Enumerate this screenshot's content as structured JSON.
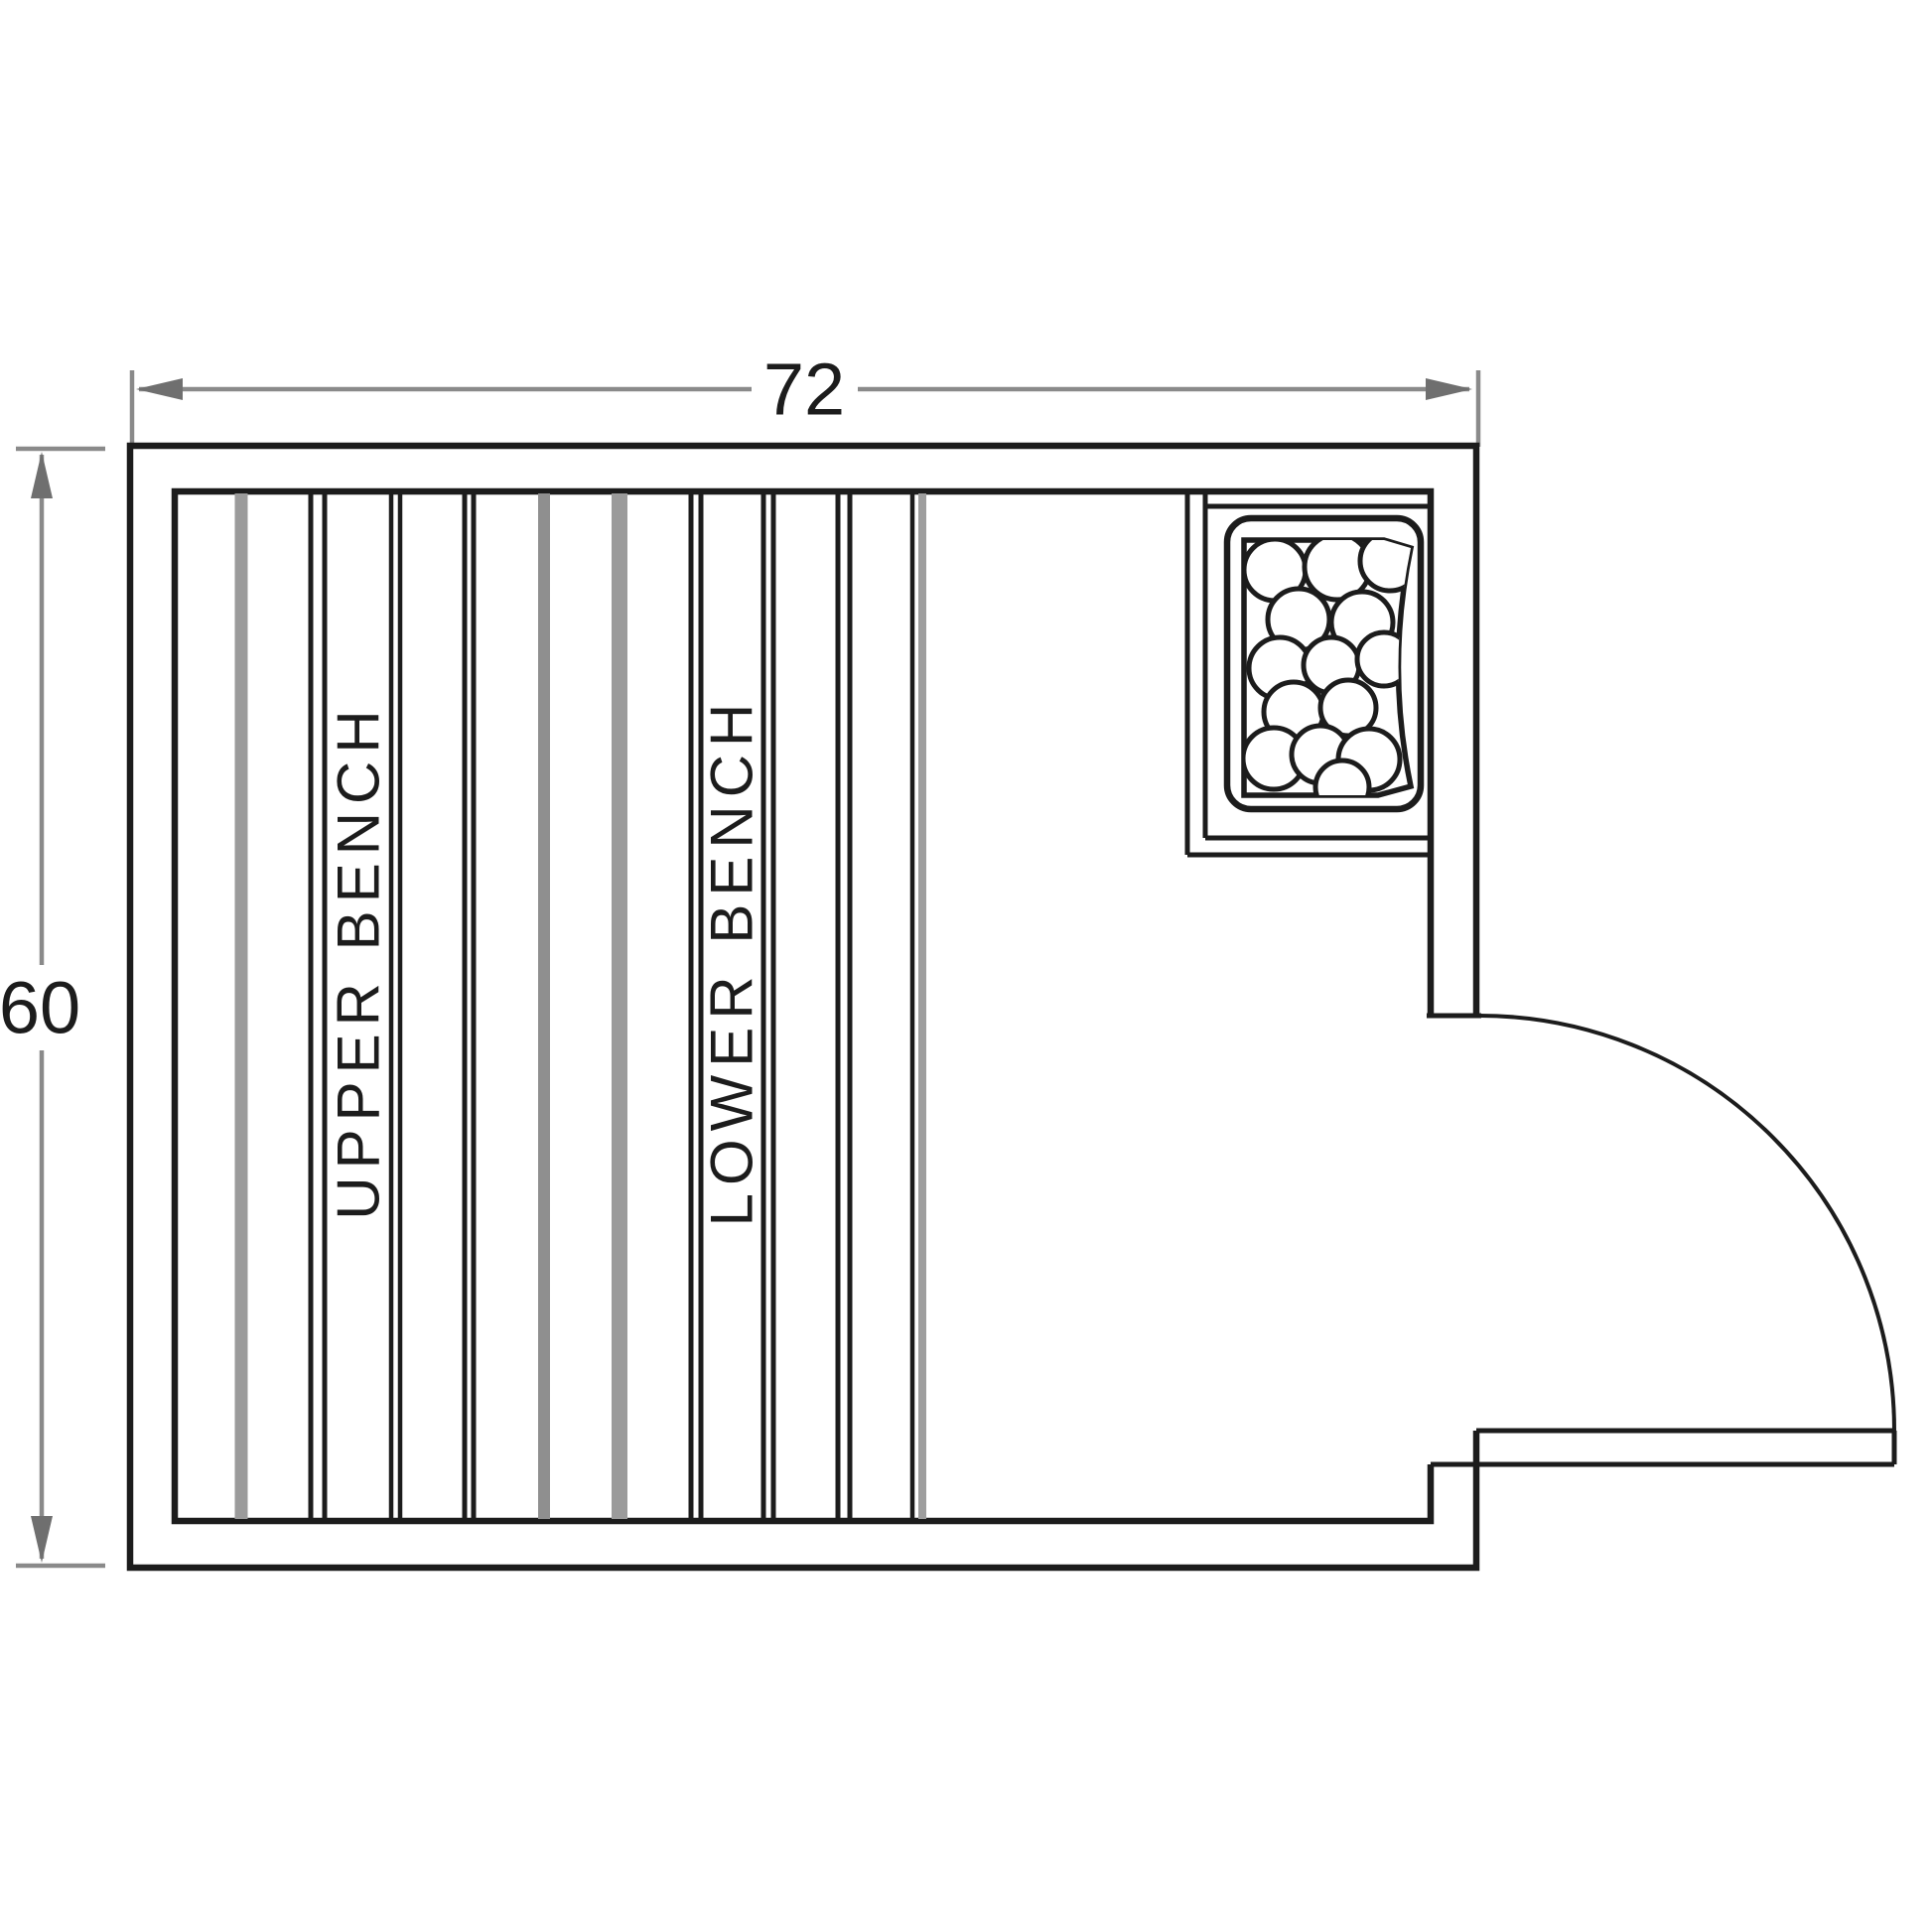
{
  "drawing": {
    "type": "sauna-floor-plan",
    "dimensions": {
      "width": "72",
      "height": "60"
    },
    "benches": {
      "upper": "UPPER BENCH",
      "lower": "LOWER BENCH"
    },
    "features": {
      "heater": "rock-heater-top-right",
      "heater_stone_count": 14,
      "door": "right-side-quarter-swing-door"
    },
    "colors": {
      "line": "#1c1c1c",
      "dimension_line": "#8a8a8a",
      "board_gray": "#9b9b9b",
      "background": "#ffffff"
    }
  }
}
